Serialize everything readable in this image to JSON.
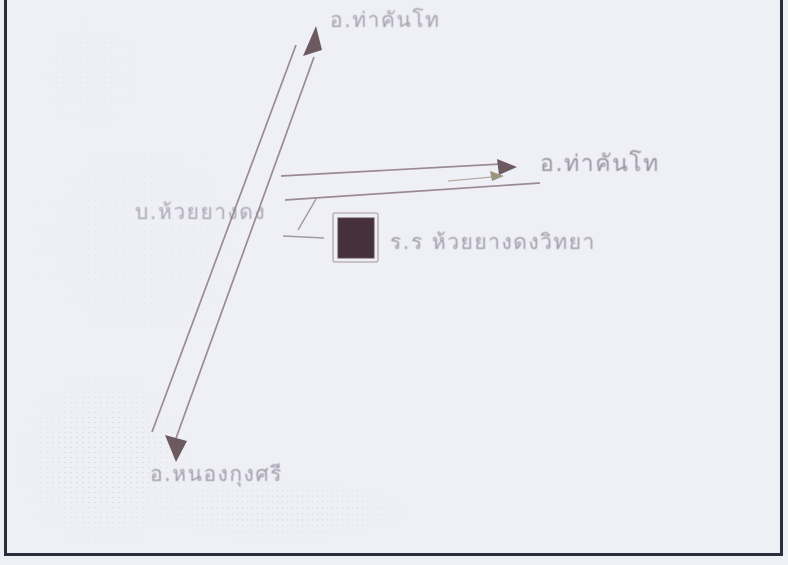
{
  "page": {
    "background": "#eef0f6",
    "border_color": "#2b2e3c",
    "description": "Hand-drawn scanned sketch map showing directions to a school"
  },
  "map": {
    "labels": {
      "top_destination": "อ.ท่าคันโท",
      "right_destination": "อ.ท่าคันโท",
      "village": "บ.ห้วยยางดง",
      "school": "ร.ร ห้วยยางดงวิทยา",
      "bottom_destination": "อ.หนองกุงศรี"
    },
    "colors": {
      "road": "#9c8a91",
      "arrow": "#6d5a60",
      "building": "#46313a",
      "building-outline": "#bdb2b6",
      "label": "#8e8698"
    }
  }
}
